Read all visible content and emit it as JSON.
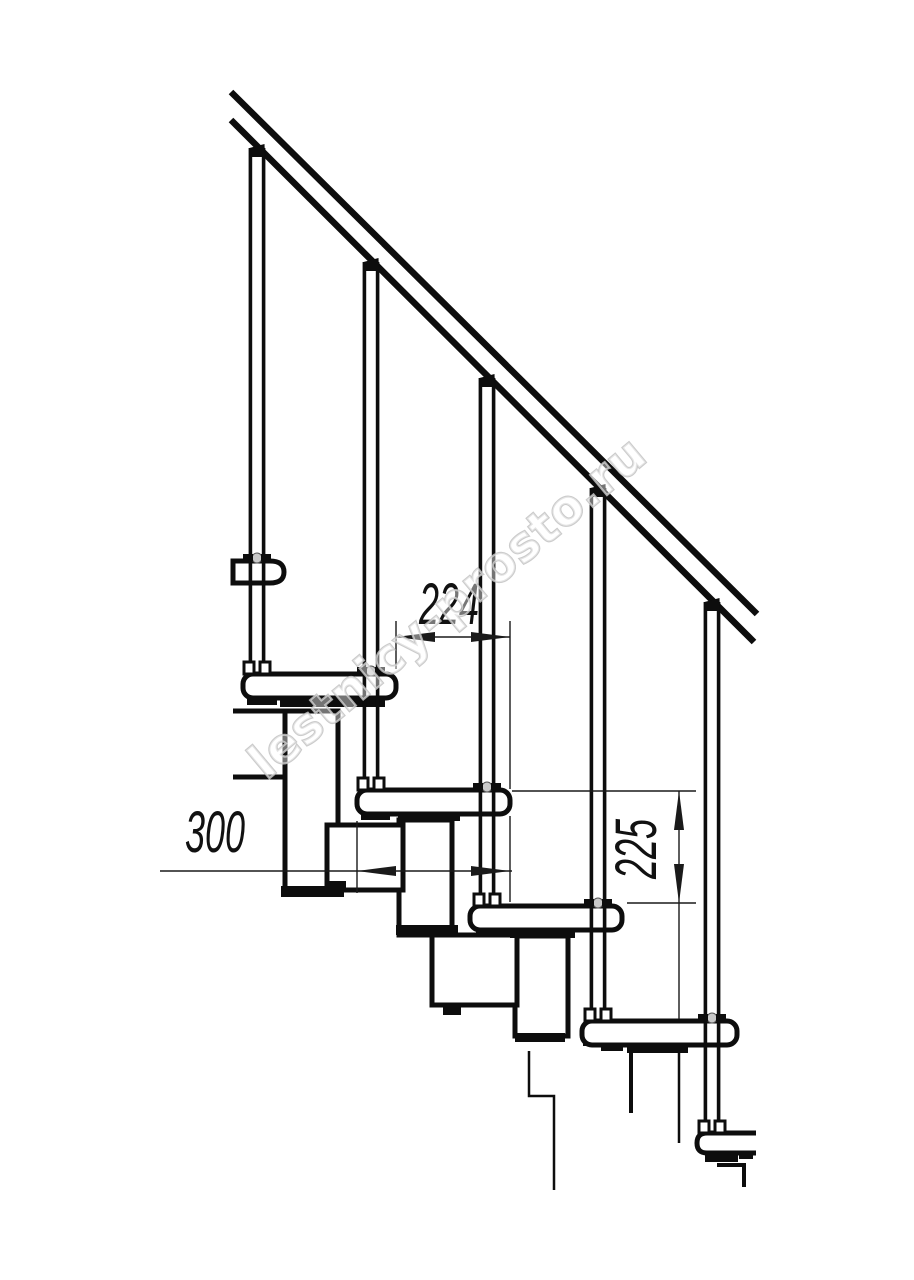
{
  "drawing": {
    "type": "staircase-side-view-technical-drawing",
    "dimensions": {
      "tread_going": "224",
      "tread_depth": "300",
      "riser_height": "225"
    },
    "watermark": "lestnicy-prosto.ru",
    "colors": {
      "line": "#0d0d0d",
      "background": "#ffffff",
      "watermark_outline": "#c2c2c2"
    }
  }
}
